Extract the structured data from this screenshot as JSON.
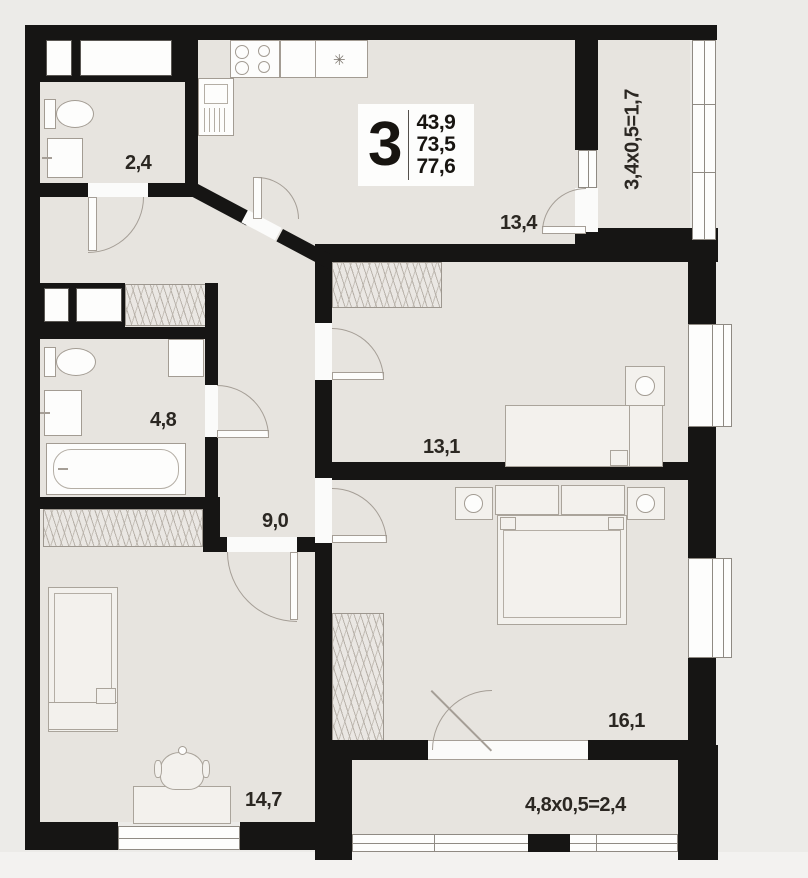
{
  "plan": {
    "legend": {
      "rooms_count": "3",
      "areas": {
        "living": "43,9",
        "apartment": "73,5",
        "total": "77,6"
      }
    },
    "rooms": {
      "wc": {
        "name": "wc",
        "area": "2,4"
      },
      "bathroom": {
        "name": "bathroom",
        "area": "4,8"
      },
      "hallway": {
        "name": "hallway",
        "area": "9,0"
      },
      "kitchen_living": {
        "name": "kitchen-living room",
        "area": "13,4"
      },
      "bedroom1": {
        "name": "bedroom 1",
        "area": "13,1"
      },
      "bedroom2": {
        "name": "bedroom 2",
        "area": "16,1"
      },
      "bedroom3": {
        "name": "bedroom 3",
        "area": "14,7"
      }
    },
    "balconies": {
      "right": {
        "formula": "3,4x0,5=1,7"
      },
      "bottom": {
        "formula": "4,8x0,5=2,4"
      }
    },
    "icons": {
      "kitchen_sink": "✳"
    },
    "colors": {
      "wall": "#161514",
      "floor": "#e7e4df",
      "background": "#ecebe8"
    }
  }
}
